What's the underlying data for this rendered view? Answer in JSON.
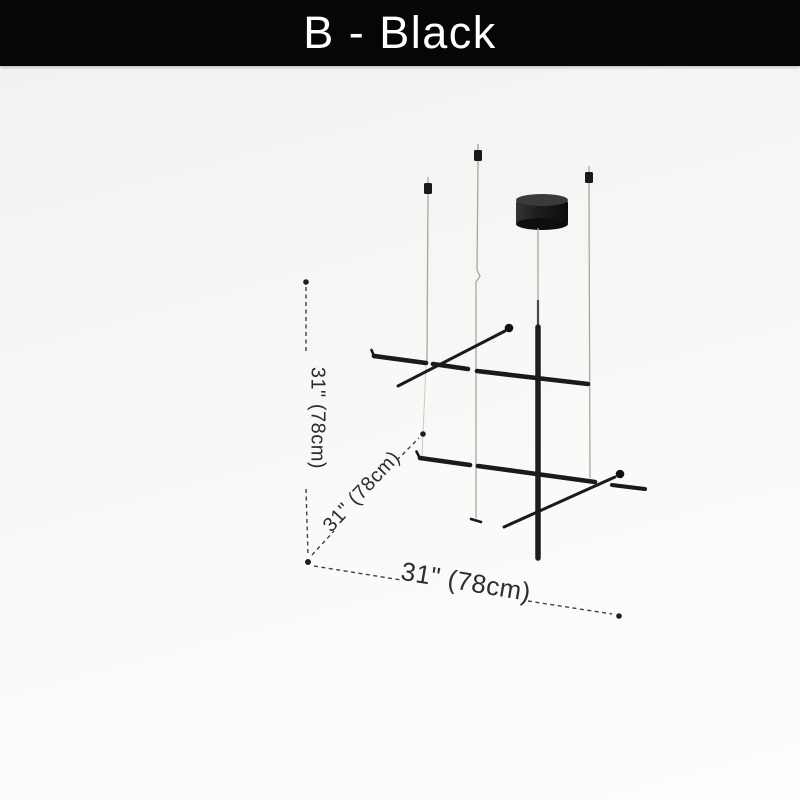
{
  "header": {
    "title": "B - Black"
  },
  "dimensions": {
    "height": "31\" (78cm)",
    "depth": "31\" (78cm)",
    "width": "31\" (78cm)"
  },
  "theme": {
    "banner_bg": "#060606",
    "banner_text": "#ffffff",
    "lamp_black": "#1a1a1a",
    "wire_gray": "#a6a6a1",
    "dim_line": "#424242",
    "dim_text": "#2d2d2d"
  }
}
